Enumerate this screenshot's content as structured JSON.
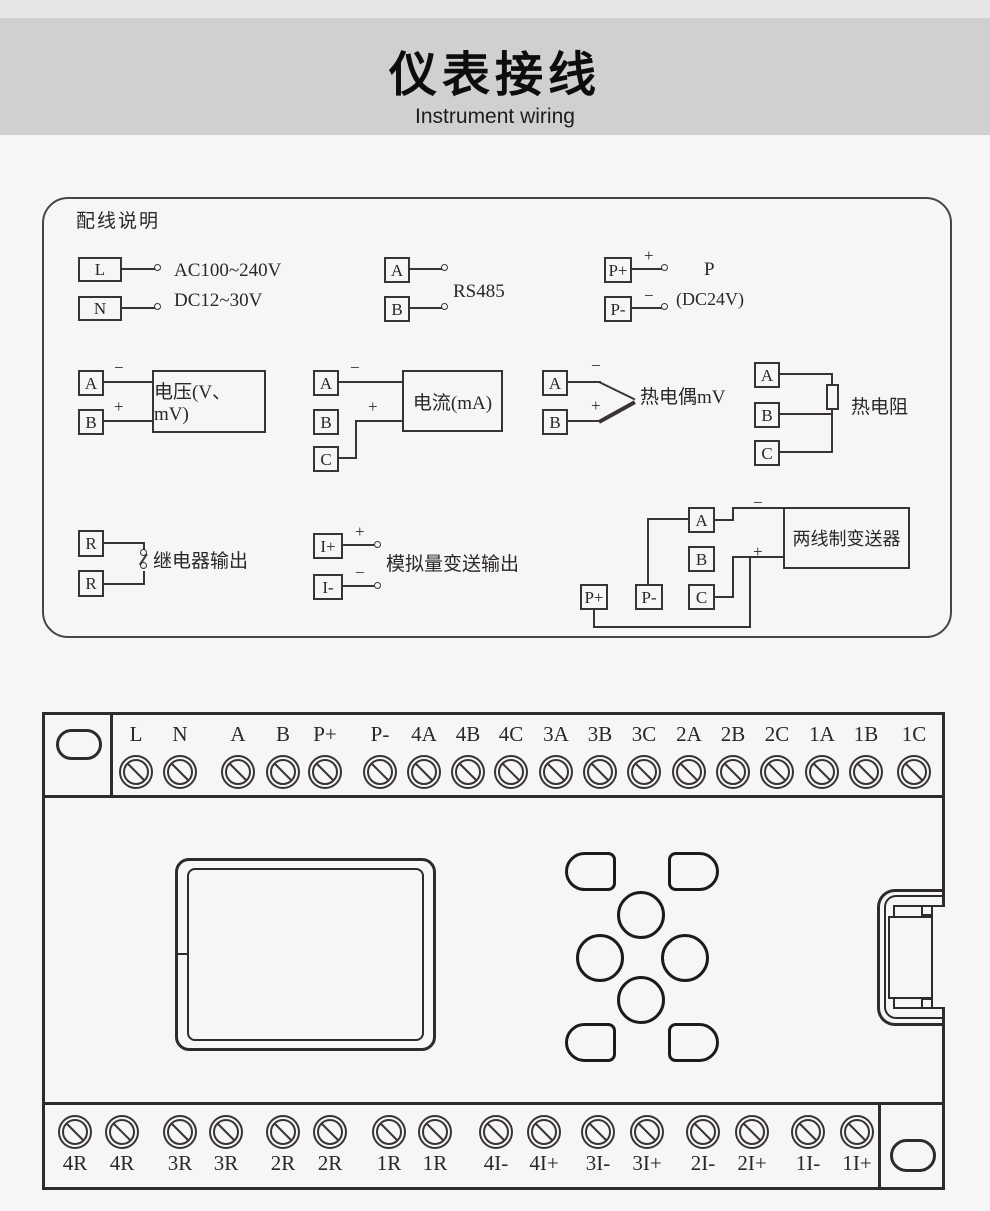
{
  "header": {
    "title": "仪表接线",
    "subtitle": "Instrument wiring"
  },
  "panel": {
    "title": "配线说明",
    "power": {
      "t1": "L",
      "t2": "N",
      "line1": "AC100~240V",
      "line2": "DC12~30V"
    },
    "rs485": {
      "t1": "A",
      "t2": "B",
      "label": "RS485"
    },
    "dc24": {
      "t1": "P+",
      "t2": "P-",
      "plus": "+",
      "minus": "−",
      "label1": "P",
      "label2": "(DC24V)"
    },
    "voltage": {
      "t1": "A",
      "t2": "B",
      "minus": "−",
      "plus": "+",
      "box": "电压(V、mV)"
    },
    "current": {
      "t1": "A",
      "t2": "B",
      "t3": "C",
      "minus": "−",
      "plus": "+",
      "box": "电流(mA)"
    },
    "thermocouple": {
      "t1": "A",
      "t2": "B",
      "minus": "−",
      "plus": "+",
      "label": "热电偶mV"
    },
    "rtd": {
      "t1": "A",
      "t2": "B",
      "t3": "C",
      "label": "热电阻"
    },
    "relay": {
      "t1": "R",
      "t2": "R",
      "label": "继电器输出"
    },
    "analog": {
      "t1": "I+",
      "t2": "I-",
      "plus": "+",
      "minus": "−",
      "label": "模拟量变送输出"
    },
    "twowire": {
      "p1": "P+",
      "p2": "P-",
      "t1": "A",
      "t2": "B",
      "t3": "C",
      "minus": "−",
      "plus": "+",
      "box": "两线制变送器"
    }
  },
  "terminal_block": {
    "top_labels": [
      "L",
      "N",
      "A",
      "B",
      "P+",
      "P-",
      "4A",
      "4B",
      "4C",
      "3A",
      "3B",
      "3C",
      "2A",
      "2B",
      "2C",
      "1A",
      "1B",
      "1C"
    ],
    "bottom_labels": [
      "4R",
      "4R",
      "3R",
      "3R",
      "2R",
      "2R",
      "1R",
      "1R",
      "4I-",
      "4I+",
      "3I-",
      "3I+",
      "2I-",
      "2I+",
      "1I-",
      "1I+"
    ]
  }
}
